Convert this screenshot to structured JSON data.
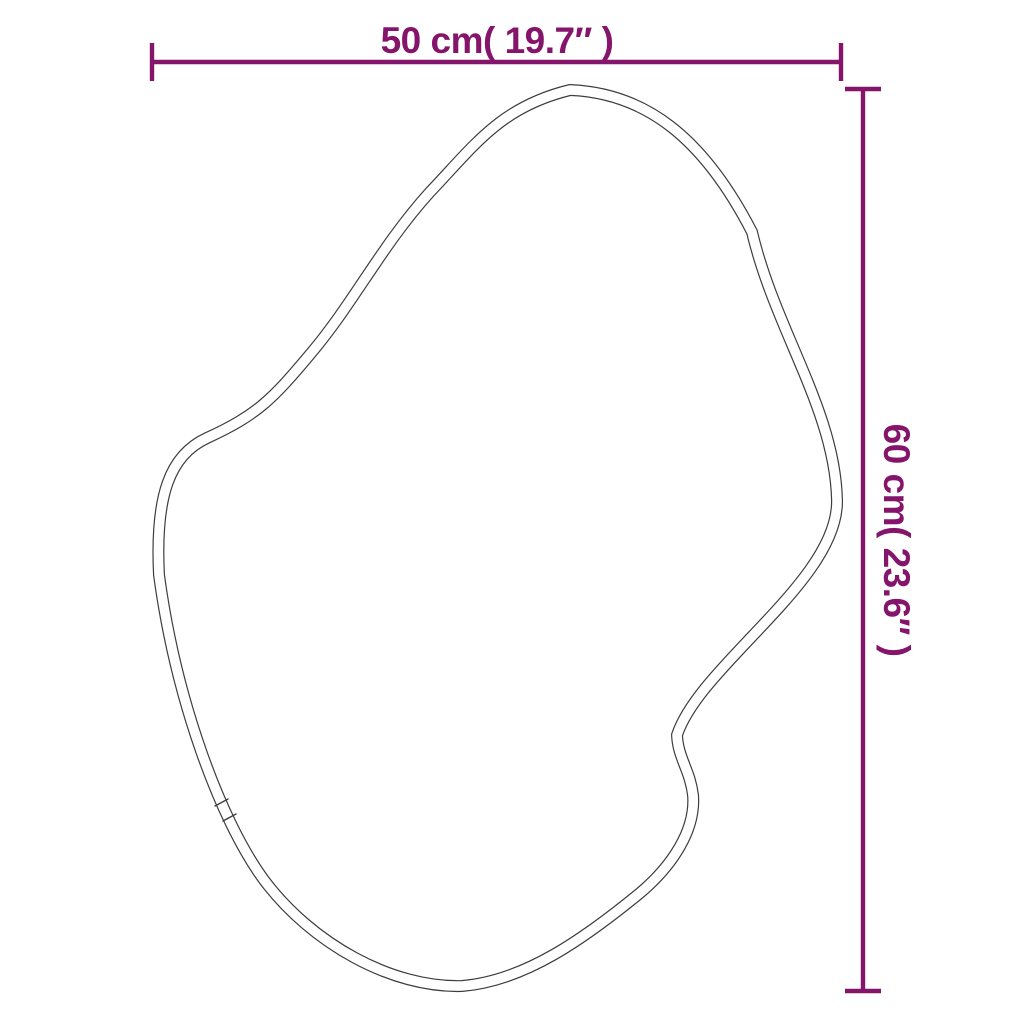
{
  "diagram": {
    "kind": "product-dimension-diagram",
    "subject": "irregular organic-shaped mirror outline (double-line frame profile with seam joint)",
    "background_color": "#ffffff",
    "outline_color": "#3d3d3d",
    "dimension_color": "#85156b",
    "width": {
      "label": "50 cm( 19.7″ )",
      "value_cm": "50",
      "value_in": "19.7"
    },
    "height": {
      "label": "60 cm( 23.6″ )",
      "value_cm": "60",
      "value_in": "23.6"
    }
  }
}
